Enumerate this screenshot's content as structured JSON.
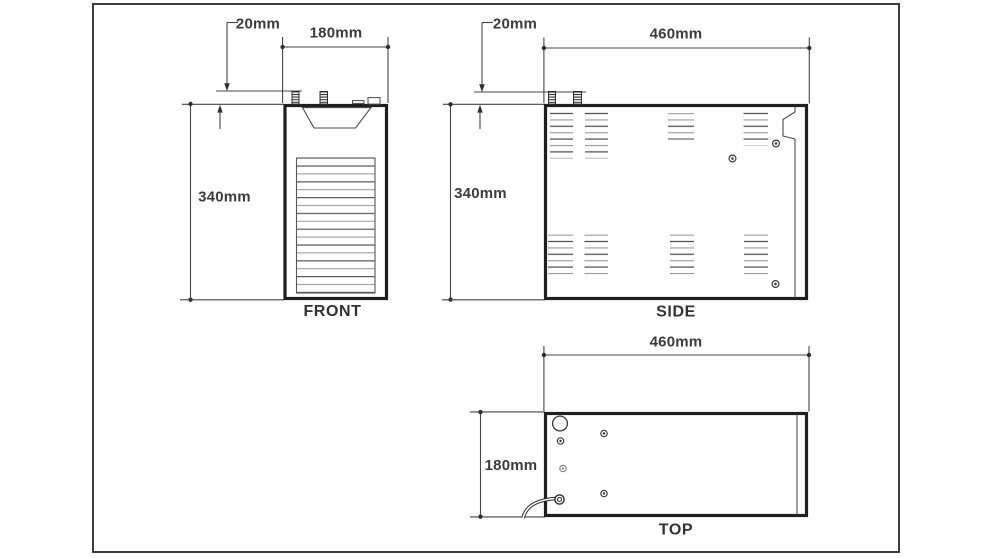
{
  "drawing": {
    "type": "orthographic-technical-drawing",
    "front": {
      "label": "FRONT",
      "offset": "20mm",
      "width": "180mm",
      "height": "340mm"
    },
    "side": {
      "label": "SIDE",
      "offset": "20mm",
      "length": "460mm",
      "height": "340mm"
    },
    "top": {
      "label": "TOP",
      "length": "460mm",
      "depth": "180mm"
    }
  },
  "values_mm": {
    "width": 180,
    "depth": 180,
    "length": 460,
    "height": 340,
    "fitting_offset": 20
  },
  "colors": {
    "background": "#ffffff",
    "frame": "#3d3d3d",
    "outline": "#1f1f1f",
    "thin_line": "#4a4a4a",
    "text": "#3b3b3b"
  }
}
